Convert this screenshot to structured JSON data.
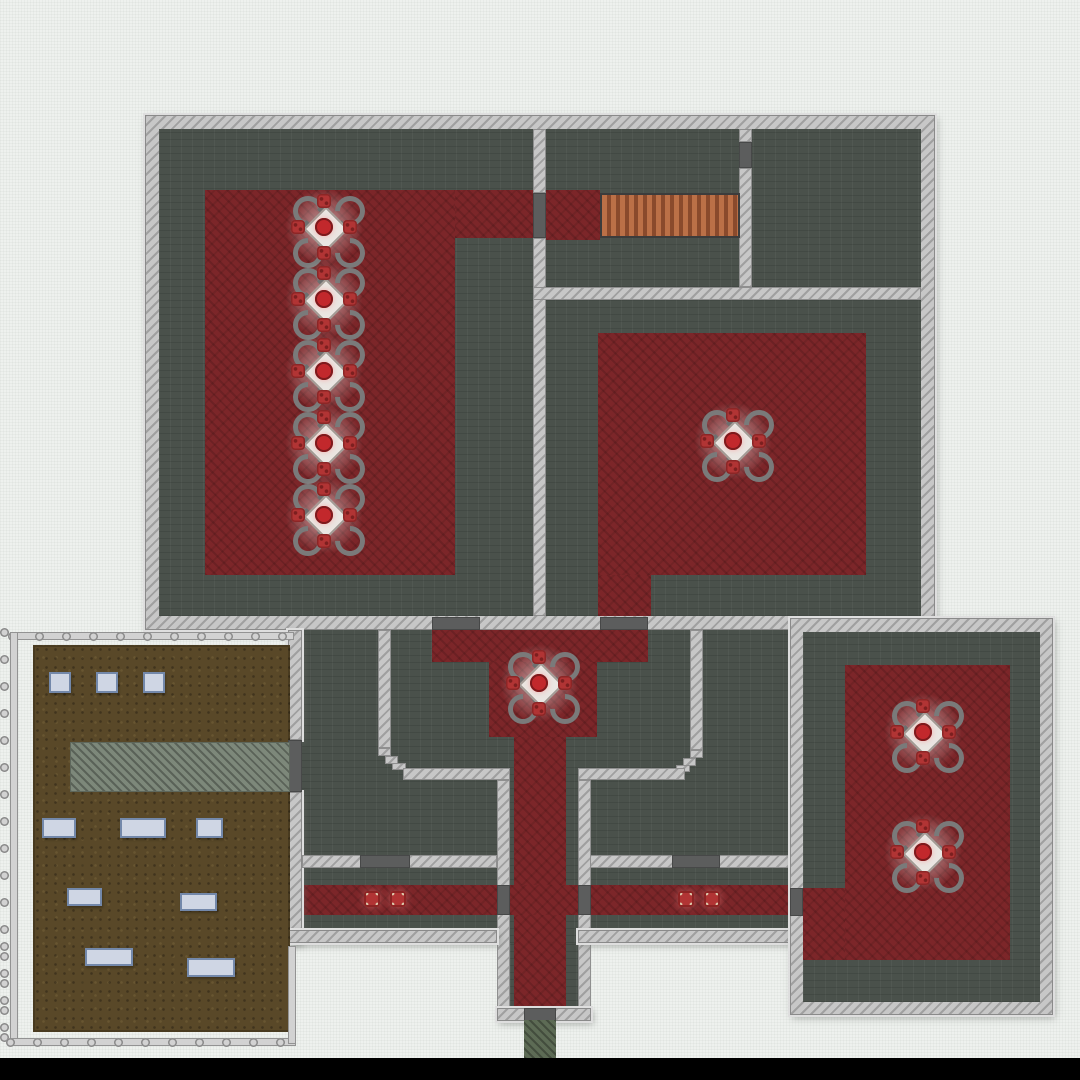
{
  "meta": {
    "description": "Top-down 2D base-building game map: a large building with dark tiled rooms, dark-red carpeted dining areas with round-service tables, a staircase, a central lobby and corridors, a lower-right dining room, a fenced dirt yard with crates and a paved path, and a south exit path",
    "bottom_bar": "black letterbox bar"
  },
  "palette": {
    "bg": "#eef1ee",
    "wall": "#c7c7c7",
    "floor": "#4a514b",
    "carpet": "#7c2629",
    "door": "#5c5d5d",
    "stairs_light": "#bb7047",
    "stairs_dark": "#8a4a2c",
    "dirt": "#594828",
    "path": "#7d887a",
    "exit": "#5d6b55",
    "fence": "#d2d2d2",
    "panel": "#cfd6e4",
    "panel_border": "#7388aa",
    "table_top": "#eae6e2",
    "chair": "#7a7a7a",
    "plate": "#b13434",
    "food": "#c2282c",
    "black": "#000000"
  },
  "map": {
    "stairs": {
      "x": 600,
      "y": 193,
      "w": 140,
      "h": 45
    },
    "doors": [
      {
        "x": 533,
        "y": 193,
        "w": 13,
        "h": 45
      },
      {
        "x": 739,
        "y": 142,
        "w": 13,
        "h": 26
      },
      {
        "x": 432,
        "y": 617,
        "w": 48,
        "h": 13
      },
      {
        "x": 600,
        "y": 617,
        "w": 48,
        "h": 13
      },
      {
        "x": 288,
        "y": 740,
        "w": 14,
        "h": 52
      },
      {
        "x": 360,
        "y": 855,
        "w": 50,
        "h": 13
      },
      {
        "x": 672,
        "y": 855,
        "w": 48,
        "h": 13
      },
      {
        "x": 497,
        "y": 885,
        "w": 13,
        "h": 30
      },
      {
        "x": 578,
        "y": 885,
        "w": 13,
        "h": 30
      },
      {
        "x": 790,
        "y": 888,
        "w": 13,
        "h": 28
      },
      {
        "x": 524,
        "y": 1008,
        "w": 32,
        "h": 13
      }
    ],
    "dining_tables": [
      {
        "cx": 324,
        "cy": 227
      },
      {
        "cx": 324,
        "cy": 299
      },
      {
        "cx": 324,
        "cy": 371
      },
      {
        "cx": 324,
        "cy": 443
      },
      {
        "cx": 324,
        "cy": 515
      },
      {
        "cx": 733,
        "cy": 441
      },
      {
        "cx": 539,
        "cy": 683
      },
      {
        "cx": 923,
        "cy": 732
      },
      {
        "cx": 923,
        "cy": 852
      }
    ],
    "floor_items": [
      {
        "cx": 372,
        "cy": 899
      },
      {
        "cx": 398,
        "cy": 899
      },
      {
        "cx": 686,
        "cy": 899
      },
      {
        "cx": 712,
        "cy": 899
      }
    ],
    "exit_path": {
      "x": 524,
      "y": 1020,
      "w": 32,
      "h": 38
    },
    "yard": {
      "path": {
        "x": 70,
        "y": 742,
        "w": 220,
        "h": 50
      },
      "panels": [
        {
          "x": 49,
          "y": 672,
          "w": 22,
          "h": 21
        },
        {
          "x": 96,
          "y": 672,
          "w": 22,
          "h": 21
        },
        {
          "x": 143,
          "y": 672,
          "w": 22,
          "h": 21
        },
        {
          "x": 42,
          "y": 818,
          "w": 34,
          "h": 20
        },
        {
          "x": 120,
          "y": 818,
          "w": 46,
          "h": 20
        },
        {
          "x": 196,
          "y": 818,
          "w": 27,
          "h": 20
        },
        {
          "x": 67,
          "y": 888,
          "w": 35,
          "h": 18
        },
        {
          "x": 180,
          "y": 893,
          "w": 37,
          "h": 18
        },
        {
          "x": 85,
          "y": 948,
          "w": 48,
          "h": 18
        },
        {
          "x": 187,
          "y": 958,
          "w": 48,
          "h": 19
        }
      ],
      "fence": {
        "post_spacing": 27,
        "bars": [
          {
            "x": 12,
            "y": 632,
            "w": 282,
            "h": 8,
            "dir": "h"
          },
          {
            "x": 10,
            "y": 632,
            "w": 8,
            "h": 414,
            "dir": "v"
          },
          {
            "x": 10,
            "y": 1038,
            "w": 286,
            "h": 8,
            "dir": "h"
          },
          {
            "x": 288,
            "y": 946,
            "w": 8,
            "h": 98,
            "dir": "v"
          }
        ]
      }
    }
  }
}
